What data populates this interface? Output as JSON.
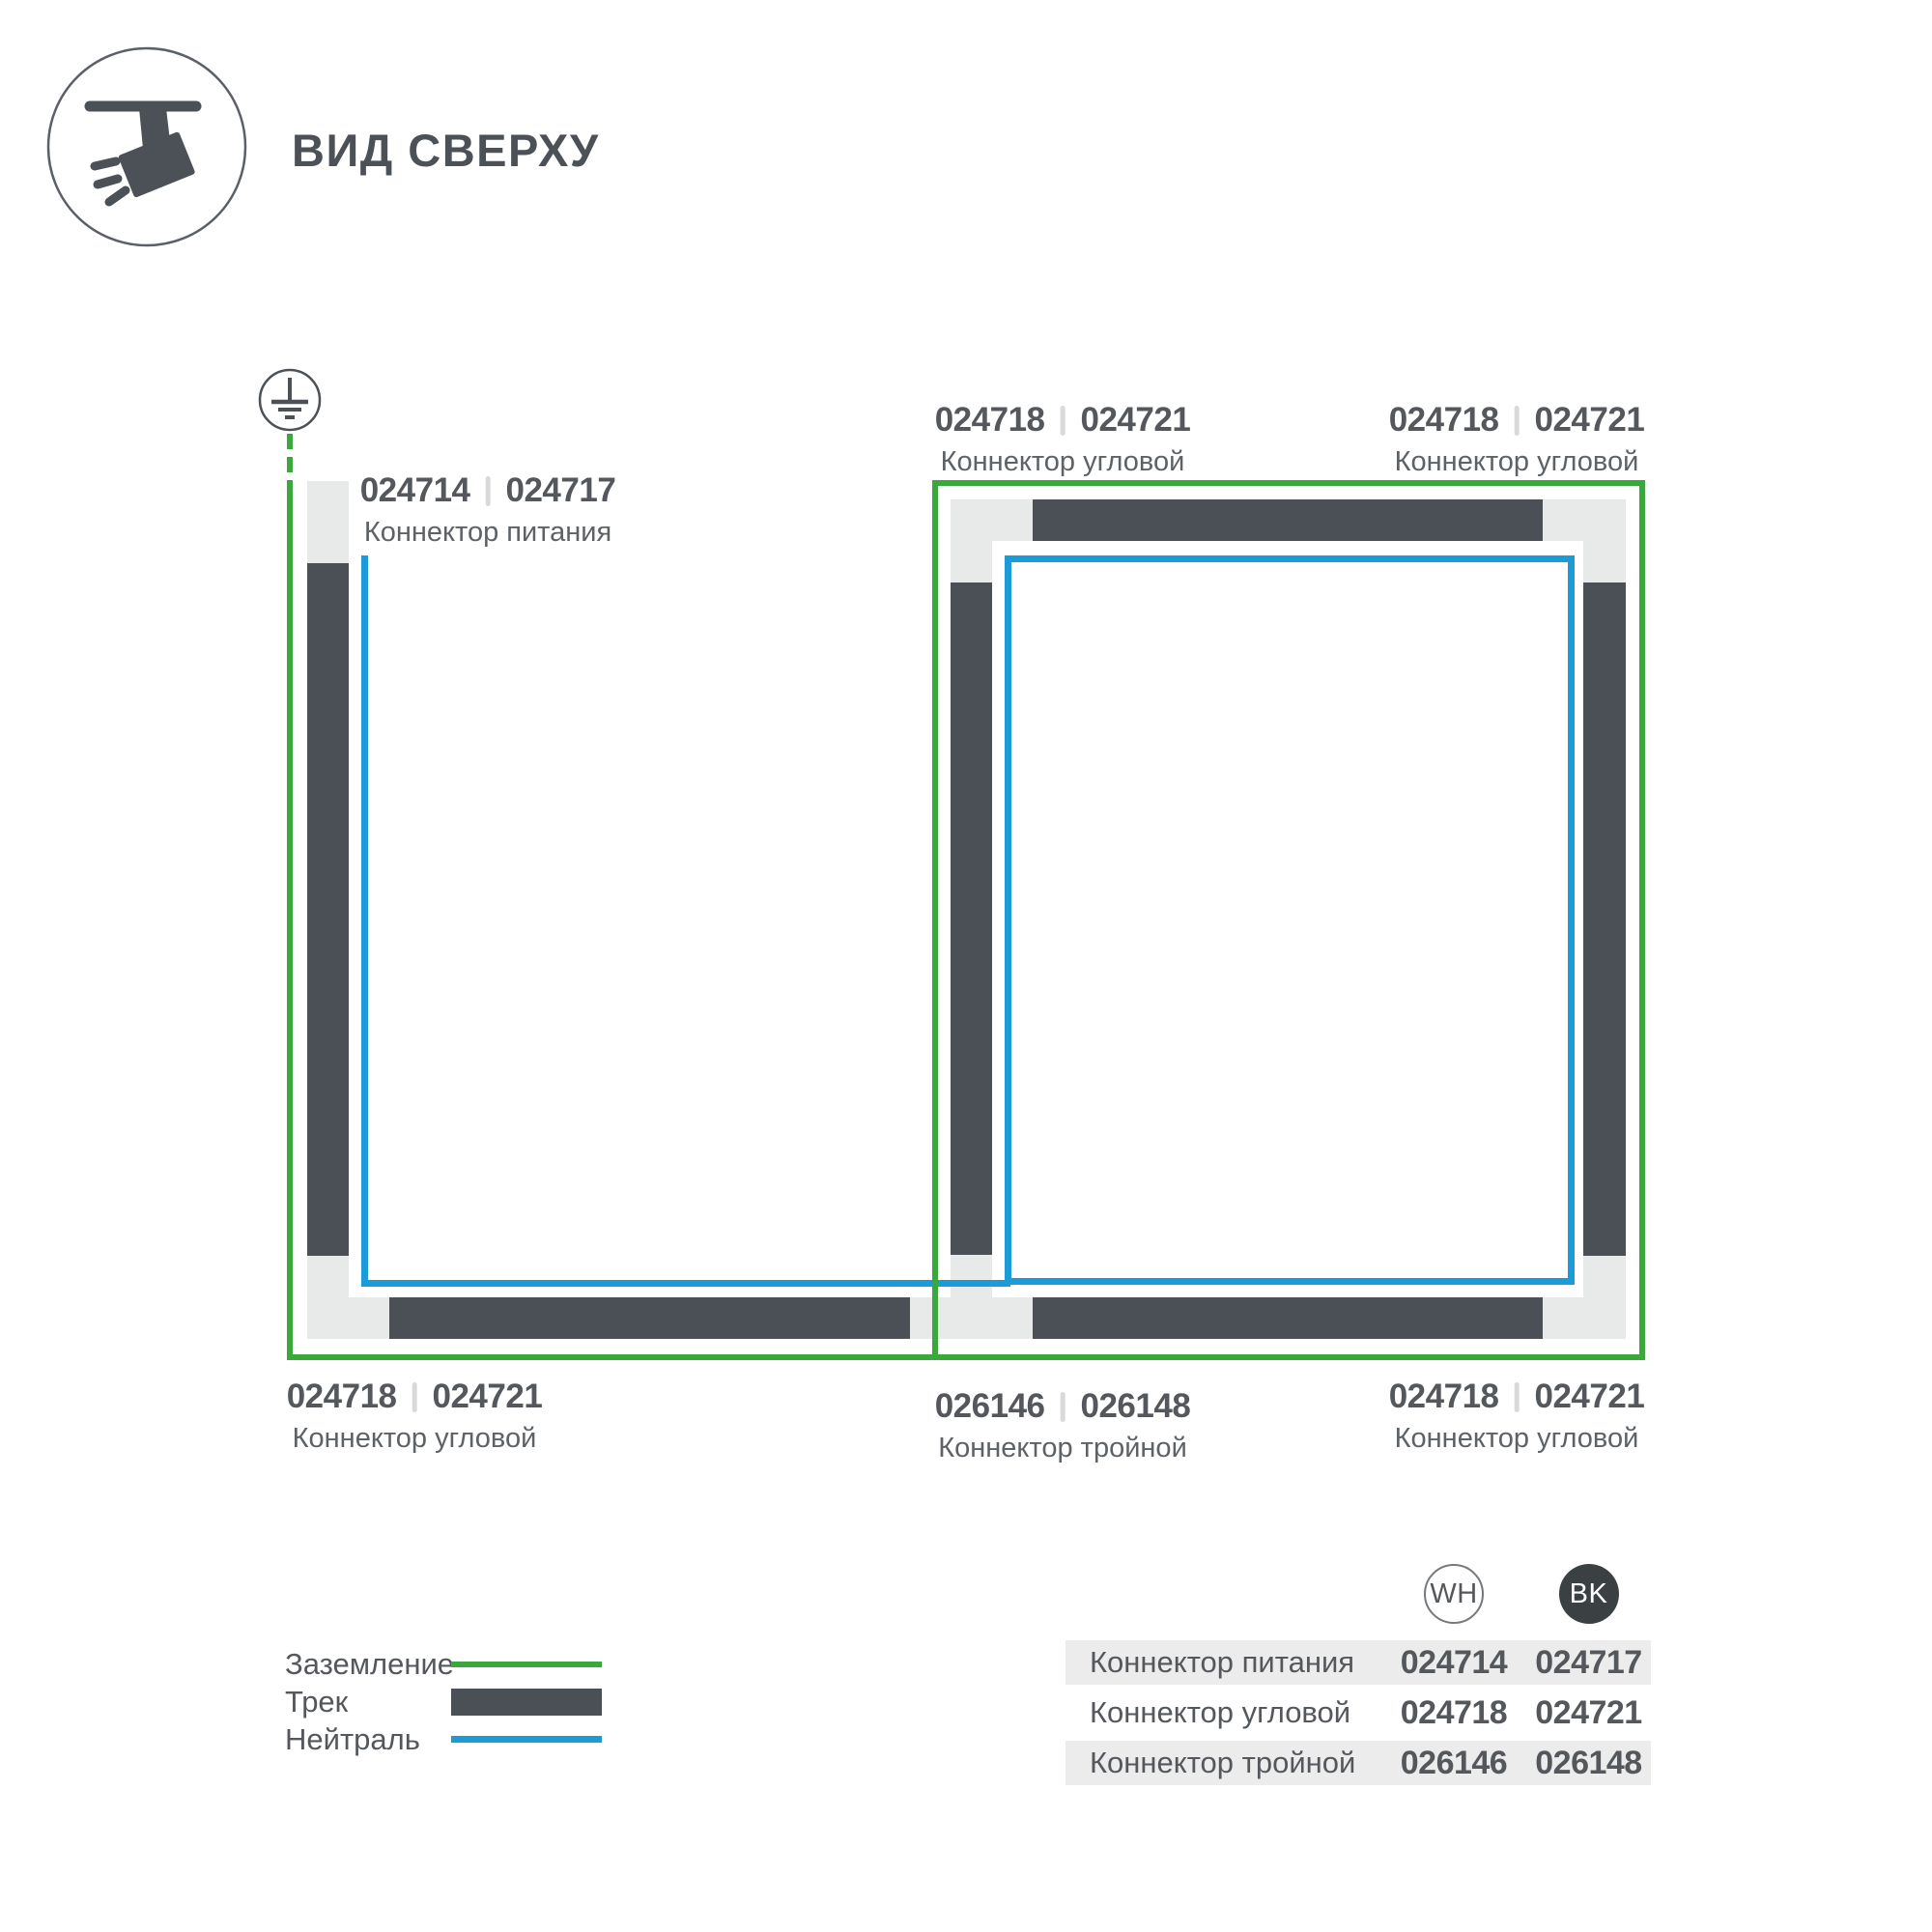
{
  "header": {
    "title": "ВИД СВЕРХУ"
  },
  "part_labels": [
    {
      "id": "power-connector",
      "codes": [
        "024714",
        "024717"
      ],
      "name": "Коннектор питания"
    },
    {
      "id": "corner-connector-top-1",
      "codes": [
        "024718",
        "024721"
      ],
      "name": "Коннектор угловой"
    },
    {
      "id": "corner-connector-top-2",
      "codes": [
        "024718",
        "024721"
      ],
      "name": "Коннектор угловой"
    },
    {
      "id": "corner-connector-bottom-left",
      "codes": [
        "024718",
        "024721"
      ],
      "name": "Коннектор угловой"
    },
    {
      "id": "triple-connector-bottom",
      "codes": [
        "026146",
        "026148"
      ],
      "name": "Коннектор тройной"
    },
    {
      "id": "corner-connector-bottom-right",
      "codes": [
        "024718",
        "024721"
      ],
      "name": "Коннектор угловой"
    }
  ],
  "legend": {
    "items": [
      {
        "id": "ground",
        "label": "Заземление"
      },
      {
        "id": "track",
        "label": "Трек"
      },
      {
        "id": "neutral",
        "label": "Нейтраль"
      }
    ]
  },
  "table": {
    "columns": [
      {
        "label": "WH"
      },
      {
        "label": "BK"
      }
    ],
    "rows": [
      {
        "name": "Коннектор питания",
        "wh": "024714",
        "bk": "024717"
      },
      {
        "name": "Коннектор угловой",
        "wh": "024718",
        "bk": "024721"
      },
      {
        "name": "Коннектор тройной",
        "wh": "026146",
        "bk": "026148"
      }
    ]
  },
  "colors": {
    "ground_green": "#3aa83a",
    "neutral_blue": "#1b9cd9",
    "track_gray": "#4a5056",
    "connector_light_gray": "#e8eaea",
    "text_dark": "#54585c"
  }
}
